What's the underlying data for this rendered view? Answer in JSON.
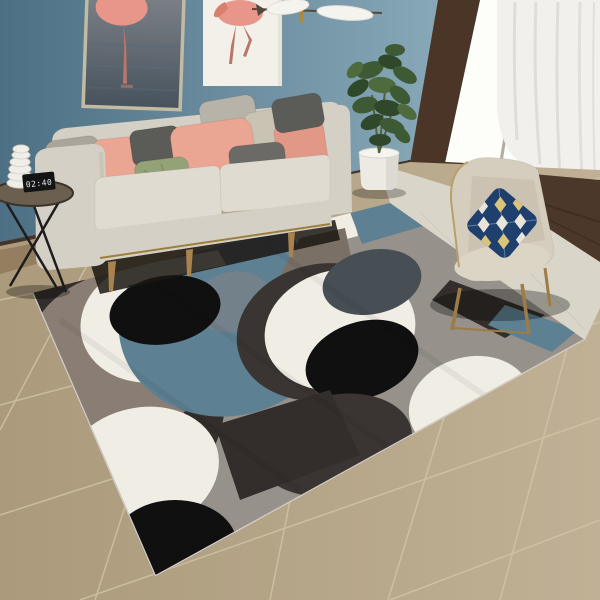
{
  "scene": {
    "title": "Living room with geometric circle-pattern area rug",
    "objects": [
      "flamingo-art-dark",
      "flamingo-art-white",
      "pendant-lamp",
      "sofa",
      "throw-pillows",
      "wire-side-table",
      "alarm-clock",
      "spiral-decor",
      "potted-plant",
      "glass-door",
      "curtain",
      "accent-chair",
      "argyle-pillow",
      "geometric-rug",
      "beige-tile-floor"
    ]
  },
  "side_table": {
    "clock_display": "02:40"
  },
  "palette": {
    "wallLeft": "#4d6f83",
    "wallRight": "#9dbdcb",
    "artLeftWaterTop": "#7c8187",
    "artLeftWater": "#47525c",
    "artLeftStreak": "#5b6a75",
    "flamingoPink": "#e8968a",
    "flamingoDeep": "#d97f6d",
    "flamingoLeg": "#b9766a",
    "artRightBg": "#f2f0e9",
    "frameGoldLeft": "#c2bba4",
    "frameWhite": "#e6e2d6",
    "lampWhite": "#f5f3ee",
    "lampGold": "#ad8a3a",
    "lampRod": "#5a4a33",
    "windowFrame": "#4a3526",
    "glass": "#fdfdfa",
    "curtain": "#f1f0ec",
    "curtainFold": "#d9d8d3",
    "darkFloor": "#4c382a",
    "marble": "#d9d5c9",
    "marbleLine": "#c6c2b5",
    "tileLeft": "#ab9a7b",
    "tileRight": "#c0b095",
    "grout": "#d2c5a8",
    "baseboard": "#44342a",
    "woodStrip": "#8a7254",
    "rugBase": "#96918a",
    "rugTeal": "#5d8192",
    "rugWhite": "#f0ede5",
    "rugBlack": "#101010",
    "rugCharcoal": "#332e2b",
    "rugWarmGray": "#8a7e74",
    "rugSlateDisc": "#474f55",
    "rugSlateInner": "#75818a",
    "rugTaupe": "#7b7066",
    "rugDark": "#3a3532",
    "rugBinding": "#cfc9c0",
    "sofaBody": "#d5d0c5",
    "sofaLight": "#e0dbd0",
    "sofaShade": "#c2bdb1",
    "goldTrim": "#9c7f3e",
    "woodLeg": "#a9824f",
    "shadow": "#1b1612",
    "pillowGray": "#a9a59b",
    "pillowPink": "#eba593",
    "pillowPinkDeep": "#e29887",
    "pillowCharcoal": "#5b5b57",
    "pillowGreen": "#93a377",
    "pillowLightGray": "#b7b3a8",
    "pillowBeige": "#c9c3b4",
    "pillowDarkGray": "#6b6a66",
    "chairBody": "#d5cdbd",
    "chairLight": "#dcd4c4",
    "chairShade": "#c3baa8",
    "chairPiping": "#b9a06a",
    "chairWood": "#9d7c46",
    "navyPillow": "#1f3f6e",
    "diamondWhite": "#e8e4d8",
    "diamondGold": "#d9c47a",
    "plantGreen": "#3d5a34",
    "plantDark": "#2e4829",
    "plantLight": "#4e6b3e",
    "stem": "#55603c",
    "potWhite": "#eceae3",
    "potShade": "#d8d6cd",
    "tableTop": "#6b5f4f",
    "tableRim": "#3a332a",
    "tableLegs": "#1d1d1d",
    "decorWhite": "#f0eee8",
    "decorLine": "#d8d4ca",
    "clockBody": "#141414",
    "clockText": "#dfe5e8"
  }
}
